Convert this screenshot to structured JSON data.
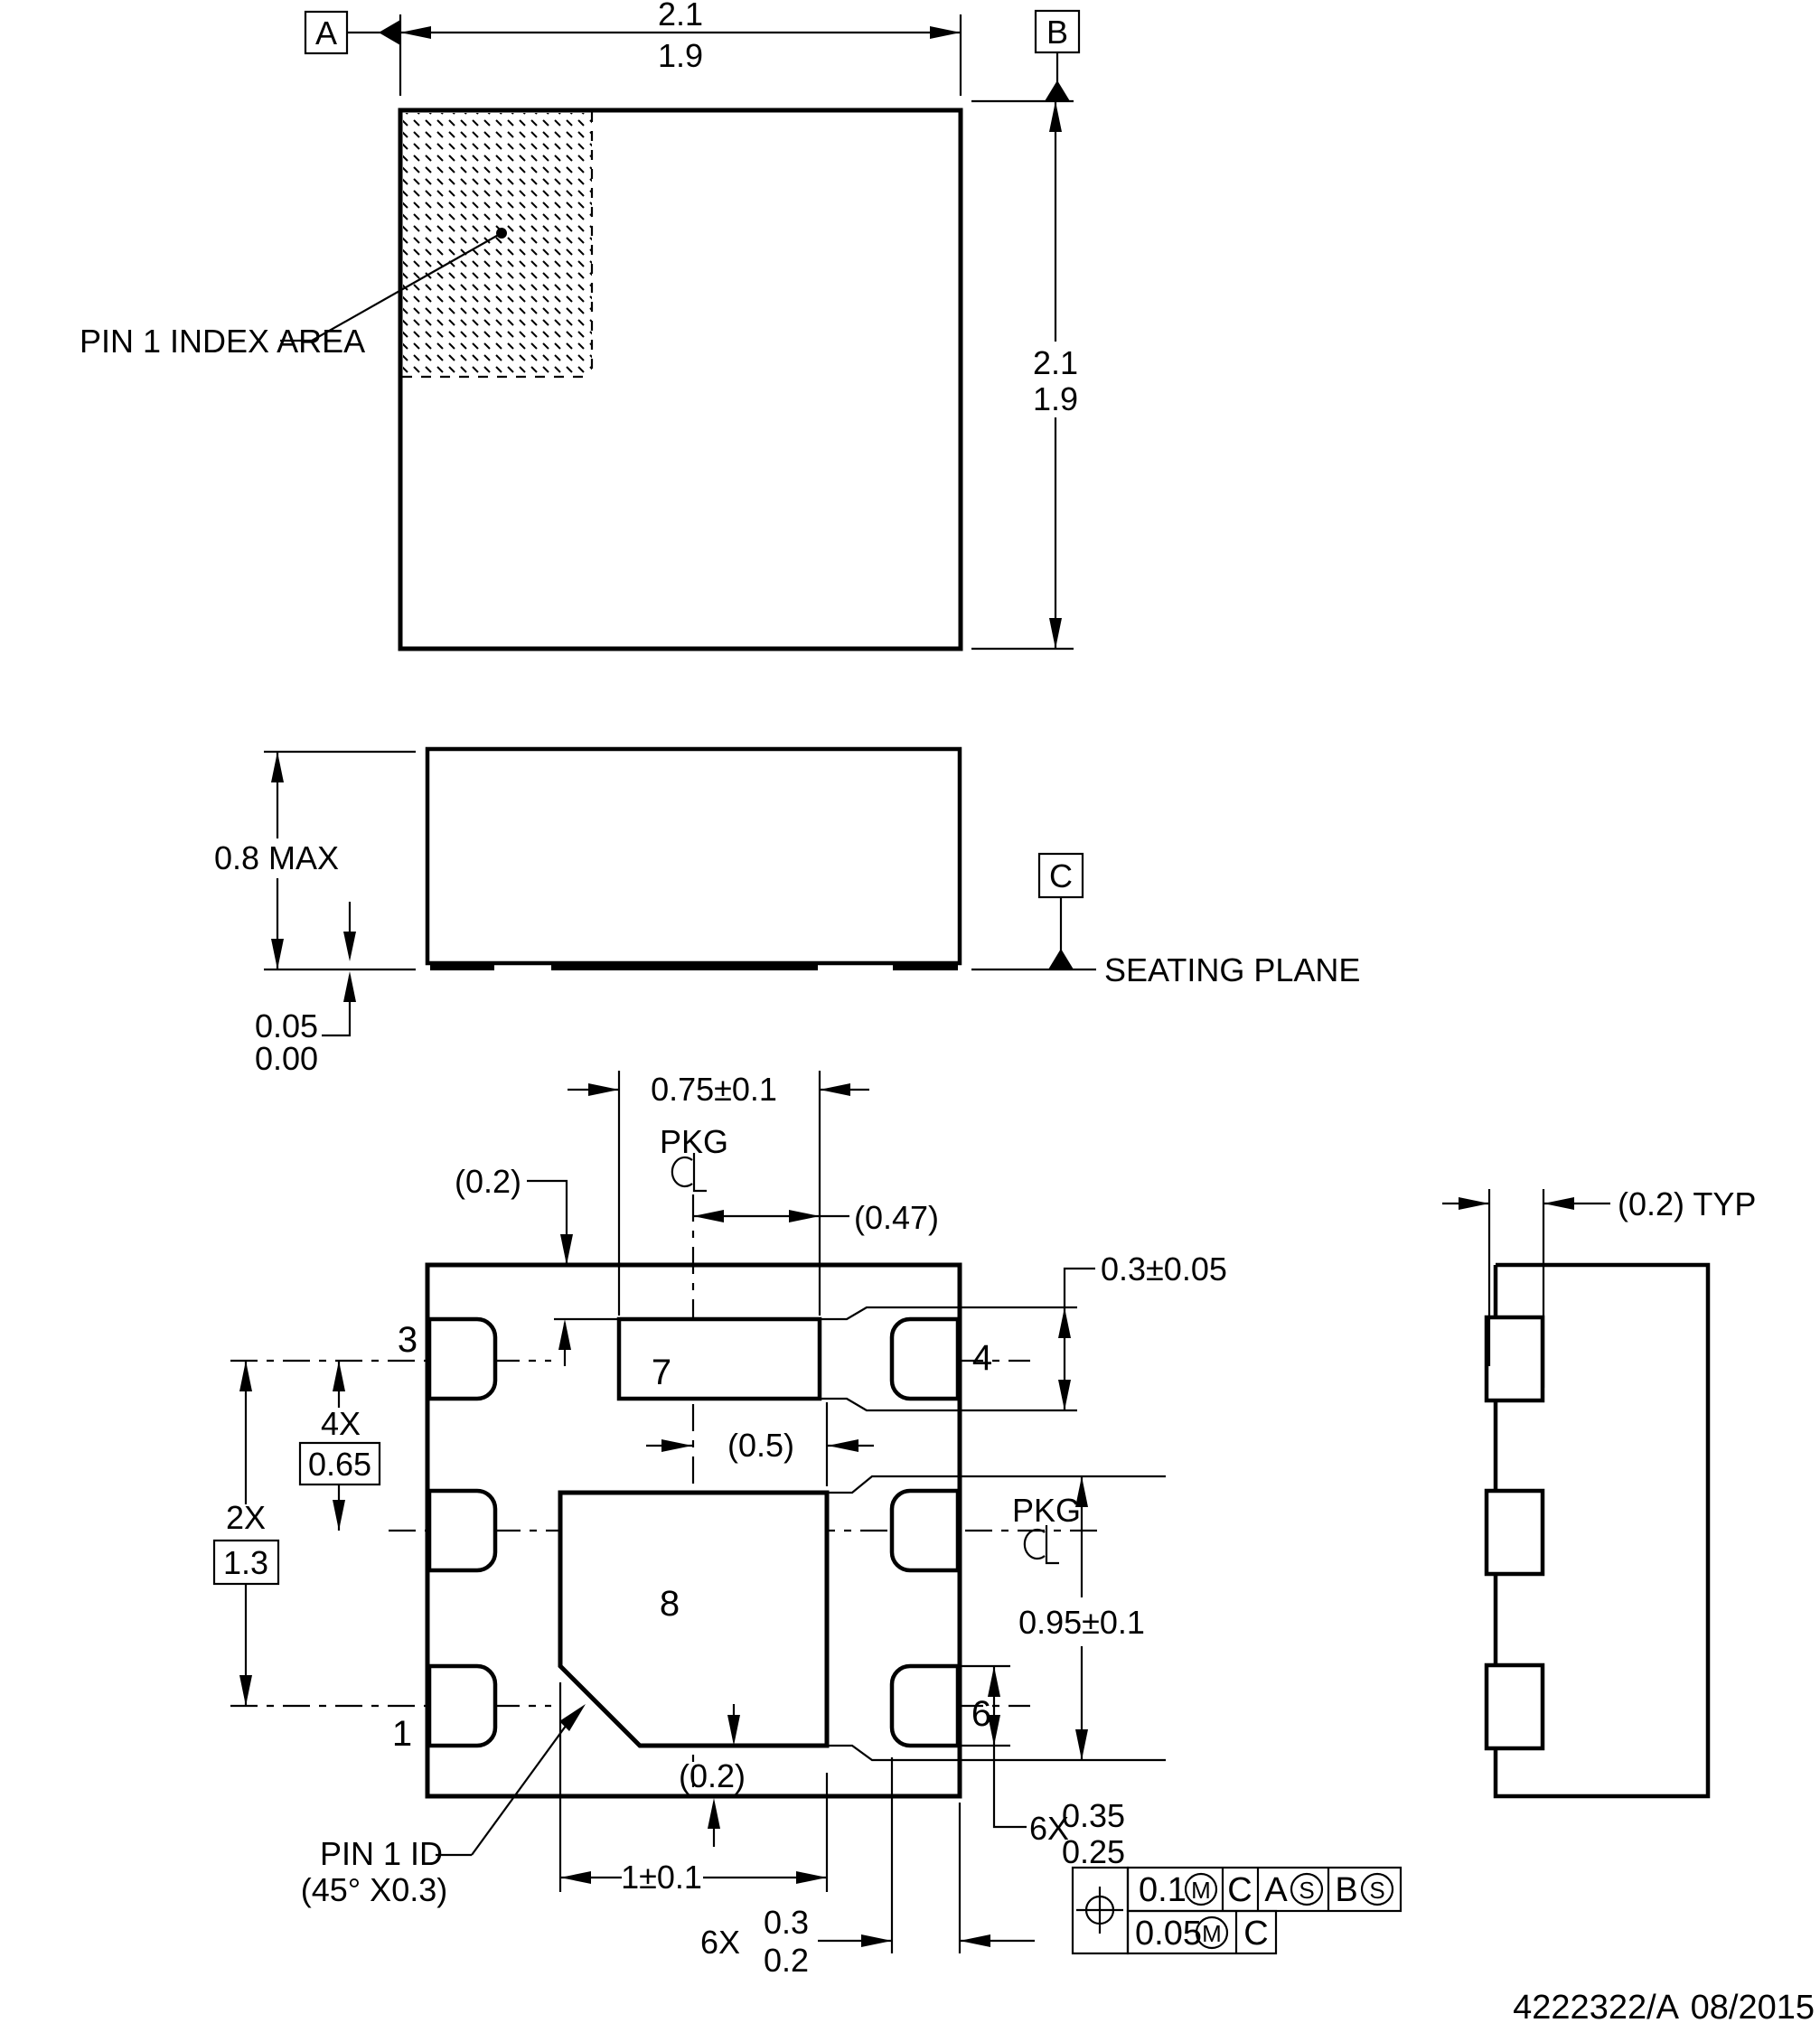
{
  "top_view": {
    "datum_a": "A",
    "datum_b": "B",
    "width_dim_max": "2.1",
    "width_dim_min": "1.9",
    "height_dim_max": "2.1",
    "height_dim_min": "1.9",
    "pin1_index": "PIN 1 INDEX AREA"
  },
  "side_view": {
    "height": "0.8 MAX",
    "standoff_max": "0.05",
    "standoff_min": "0.00",
    "datum_c": "C",
    "seating_plane": "SEATING PLANE"
  },
  "bottom_view": {
    "pad7_width": "0.75±0.1",
    "pkg_top": "PKG",
    "pkg_right": "PKG",
    "gap_top": "(0.2)",
    "cl_to_pad7": "(0.47)",
    "pad_len": "0.3±0.05",
    "cl_to_pad8": "(0.5)",
    "pad8_height": "0.95±0.1",
    "gap_bottom": "(0.2)",
    "pitch_count": "4X",
    "pitch": "0.65",
    "span_count": "2X",
    "span": "1.3",
    "pad8_width": "1±0.1",
    "pin1_id_line1": "PIN 1 ID",
    "pin1_id_line2": "(45° X0.3)",
    "pad_len6_count": "6X",
    "pad_len6_max": "0.35",
    "pad_len6_min": "0.25",
    "pad_w6_count": "6X",
    "pad_w6_max": "0.3",
    "pad_w6_min": "0.2",
    "pins": {
      "p1": "1",
      "p3": "3",
      "p4": "4",
      "p6": "6",
      "p7": "7",
      "p8": "8"
    }
  },
  "right_view": {
    "lead_thickness": "(0.2) TYP"
  },
  "fcf": {
    "row1": {
      "tol": "0.1",
      "mod": "M",
      "d1": "C",
      "d2": "A",
      "d2m": "S",
      "d3": "B",
      "d3m": "S"
    },
    "row2": {
      "tol": "0.05",
      "mod": "M",
      "d1": "C"
    }
  },
  "footer": {
    "doc_number": "4222322/A",
    "date": "08/2015"
  }
}
